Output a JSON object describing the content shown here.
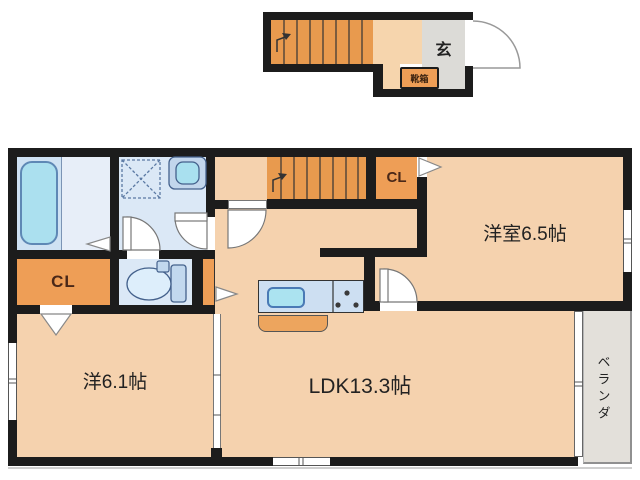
{
  "floor_plan": {
    "title": "apartment-floor-plan",
    "upper_landing": {
      "entrance_label": "玄",
      "shoe_box_label": "靴箱"
    },
    "main_floor": {
      "western_room_65": "洋室6.5帖",
      "western_room_61": "洋6.1帖",
      "ldk": "LDK13.3帖",
      "closet_1": "CL",
      "closet_2": "CL",
      "veranda": "ベランダ"
    },
    "colors": {
      "wall": "#1c1c1c",
      "room_floor": "#f5d2ae",
      "stairs_wood": "#e89a4e",
      "closet_orange": "#ee9e56",
      "wet_area_blue": "#dbe8f6",
      "fixture_cyan": "#abe0ef",
      "entry_gray": "#dcdbd7",
      "veranda_gray": "#e3e0da",
      "closet_text": "#4a2818"
    }
  }
}
